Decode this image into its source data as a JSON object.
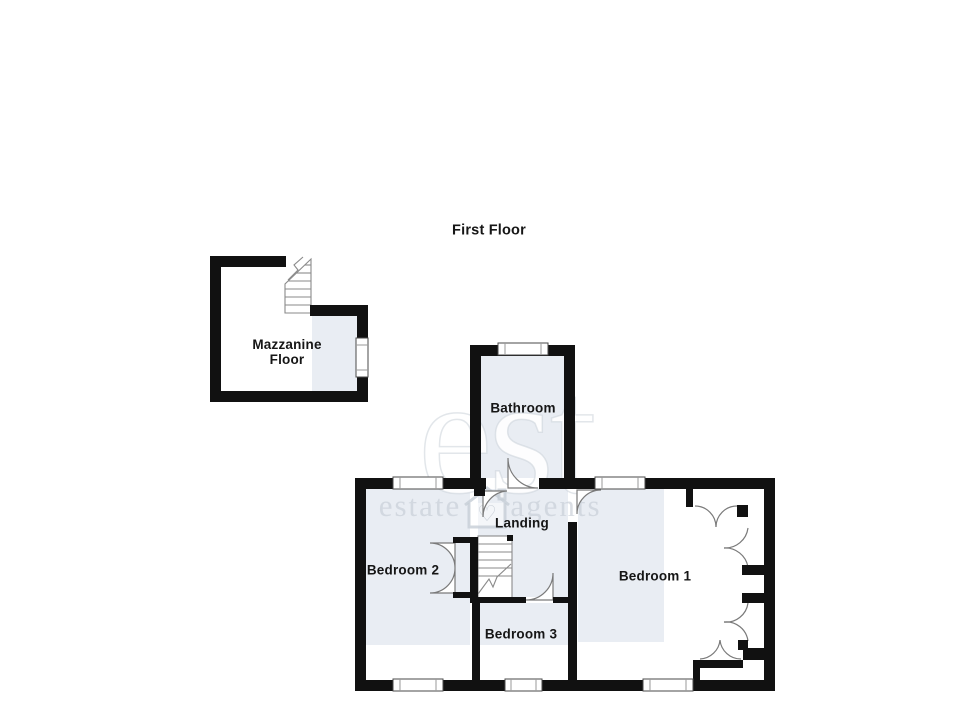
{
  "title": "First Floor",
  "rooms": {
    "mazzanine": {
      "line1": "Mazzanine",
      "line2": "Floor"
    },
    "bathroom": {
      "label": "Bathroom"
    },
    "landing": {
      "label": "Landing"
    },
    "bedroom1": {
      "label": "Bedroom 1"
    },
    "bedroom2": {
      "label": "Bedroom 2"
    },
    "bedroom3": {
      "label": "Bedroom 3"
    }
  },
  "watermark": {
    "large": "est",
    "word_left": "estate",
    "word_right": "agents",
    "icon": "house-heart-icon"
  },
  "colors": {
    "wall": "#111111",
    "room_shade": "#e9edf3",
    "plan_line": "#7a7a7a",
    "watermark": "#c6cdd6"
  }
}
